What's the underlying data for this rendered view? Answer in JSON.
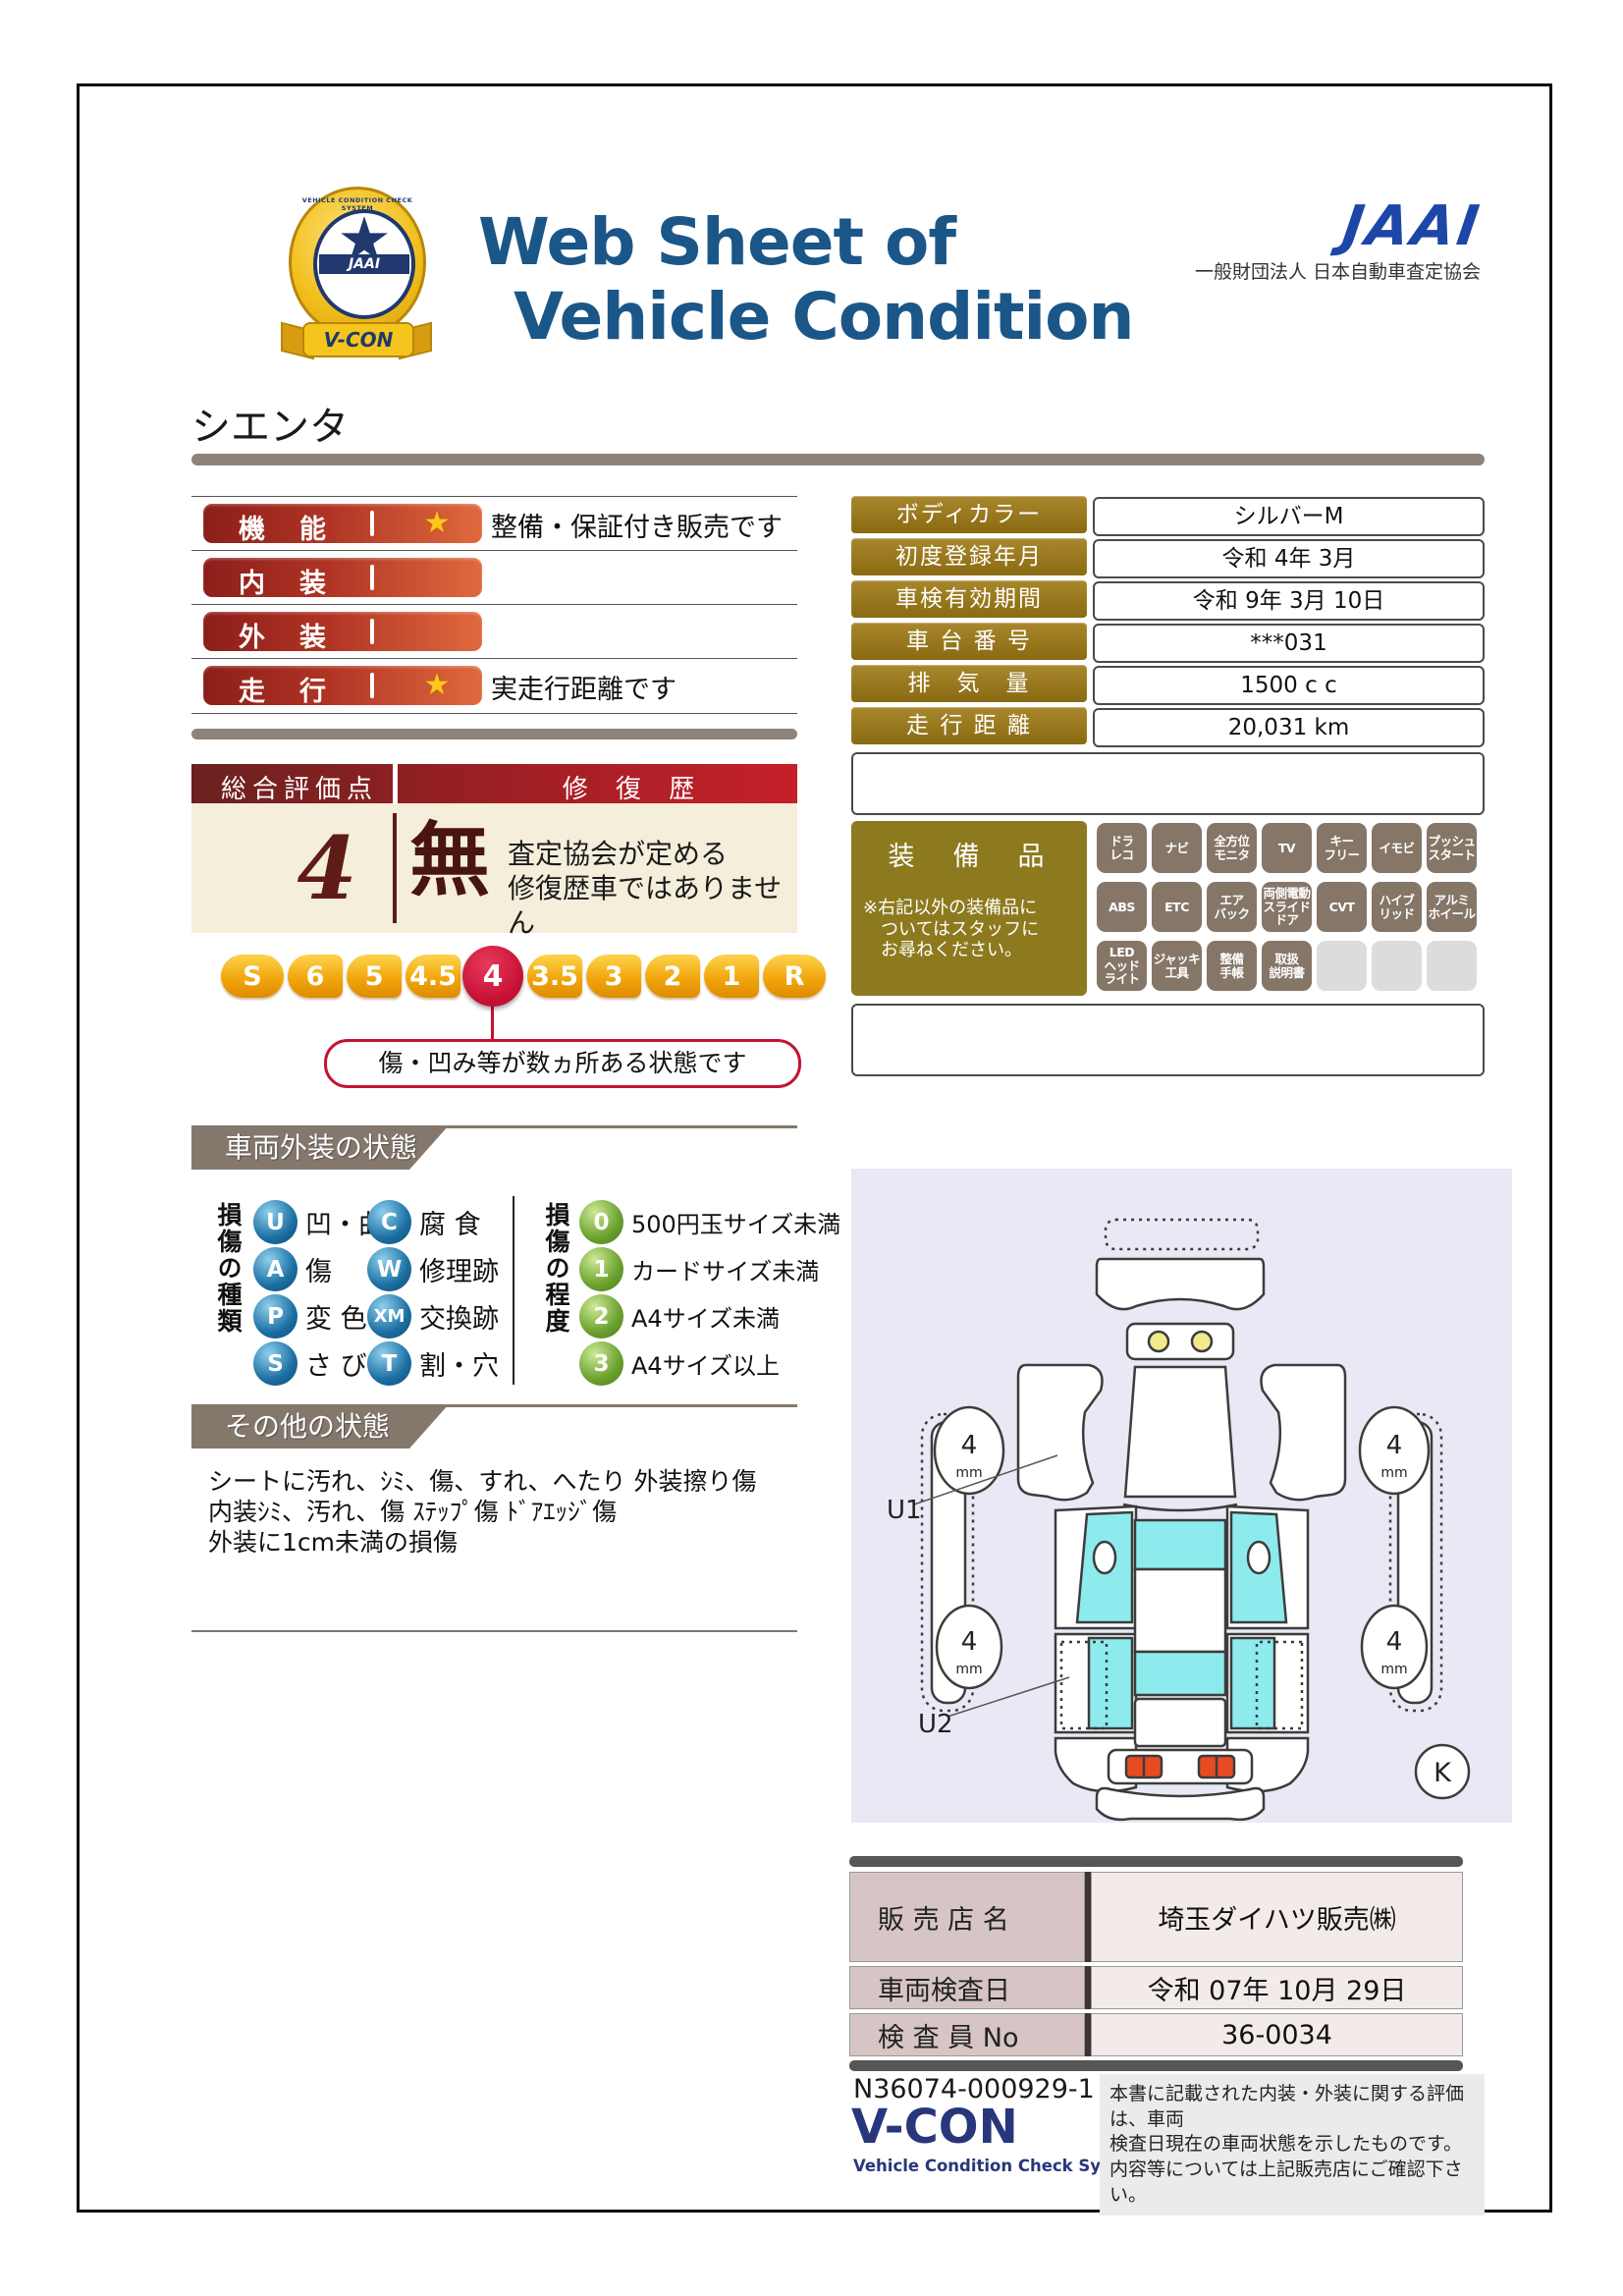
{
  "header": {
    "title_line1": "Web Sheet of",
    "title_line2": "Vehicle Condition",
    "emblem": {
      "name": "V-CON",
      "jaai": "JAAI",
      "ring_text": "VEHICLE CONDITION CHECK SYSTEM",
      "star_icon": "★"
    },
    "jaai": {
      "logo": "JAAI",
      "org": "一般財団法人 日本自動車査定協会"
    }
  },
  "vehicle_name": "シエンタ",
  "ratings": [
    {
      "label": "機　能",
      "star": "★",
      "note": "整備・保証付き販売です"
    },
    {
      "label": "内　装",
      "star": "",
      "note": ""
    },
    {
      "label": "外　装",
      "star": "",
      "note": ""
    },
    {
      "label": "走　行",
      "star": "★",
      "note": "実走行距離です"
    }
  ],
  "overall": {
    "header_left": "総合評価点",
    "header_right": "修 復 歴",
    "score": "4",
    "repair_mark": "無",
    "repair_note": "査定協会が定める\n修復歴車ではありません",
    "scale": [
      "S",
      "6",
      "5",
      "4.5",
      "4",
      "3.5",
      "3",
      "2",
      "1",
      "R"
    ],
    "selected_value": "4",
    "callout": "傷・凹み等が数ヵ所ある状態です"
  },
  "info_table": {
    "rows": [
      {
        "label": "ボディカラー",
        "value": "シルバーM"
      },
      {
        "label": "初度登録年月",
        "value": "令和 4年 3月"
      },
      {
        "label": "車検有効期間",
        "value": "令和 9年 3月 10日"
      },
      {
        "label": "車 台 番 号",
        "value": "***031"
      },
      {
        "label": "排　気　量",
        "value": "1500 c c"
      },
      {
        "label": "走 行 距 離",
        "value": "20,031 km"
      }
    ]
  },
  "equipment": {
    "title": "装　備　品",
    "note": "※右記以外の装備品に\n　ついてはスタッフに\n　お尋ねください。",
    "badges": [
      "ドラ\nレコ",
      "ナビ",
      "全方位\nモニタ",
      "TV",
      "キー\nフリー",
      "イモビ",
      "プッシュ\nスタート",
      "ABS",
      "ETC",
      "エア\nバック",
      "両側電動\nスライド\nドア",
      "CVT",
      "ハイブ\nリッド",
      "アルミ\nホイール",
      "LED\nヘッド\nライト",
      "ジャッキ\n工具",
      "整備\n手帳",
      "取扱\n説明書",
      "",
      "",
      ""
    ]
  },
  "exterior": {
    "title": "車両外装の状態",
    "kind_header": "損傷の種類",
    "kinds": [
      {
        "code": "U",
        "label": "凹・曲"
      },
      {
        "code": "A",
        "label": "傷"
      },
      {
        "code": "P",
        "label": "変 色"
      },
      {
        "code": "S",
        "label": "さ び"
      },
      {
        "code": "C",
        "label": "腐 食"
      },
      {
        "code": "W",
        "label": "修理跡"
      },
      {
        "code": "XM",
        "label": "交換跡"
      },
      {
        "code": "T",
        "label": "割・穴"
      }
    ],
    "degree_header": "損傷の程度",
    "degrees": [
      {
        "code": "0",
        "label": "500円玉サイズ未満"
      },
      {
        "code": "1",
        "label": "カードサイズ未満"
      },
      {
        "code": "2",
        "label": "A4サイズ未満"
      },
      {
        "code": "3",
        "label": "A4サイズ以上"
      }
    ]
  },
  "other": {
    "title": "その他の状態",
    "lines": [
      "シートに汚れ、ｼﾐ、傷、すれ、へたり 外装擦り傷",
      "内装ｼﾐ、汚れ、傷 ｽﾃｯﾌﾟ傷 ﾄﾞｱｴｯｼﾞ傷",
      "外装に1cm未満の損傷"
    ]
  },
  "diagram": {
    "tread_front_left": "4",
    "tread_front_right": "4",
    "tread_rear_left": "4",
    "tread_rear_right": "4",
    "tread_unit": "mm",
    "marker_u1": "U1",
    "marker_u2": "U2",
    "corner_mark": "K"
  },
  "dealer": {
    "rows": [
      {
        "label": "販 売 店 名",
        "value": "埼玉ダイハツ販売㈱"
      },
      {
        "label": "車両検査日",
        "value": "令和 07年 10月 29日"
      },
      {
        "label": "検 査 員 No",
        "value": "36-0034"
      }
    ]
  },
  "footer": {
    "serial": "N36074-000929-1",
    "vcon_logo": "V-CON",
    "vcon_tagline": "Vehicle Condition Check System",
    "disclaimer": "本書に記載された内装・外装に関する評価は、車両\n検査日現在の車両状態を示したものです。\n内容等については上記販売店にご確認下さい。"
  },
  "colors": {
    "title_navy": "#1b5688",
    "jaai_blue": "#1c46a8",
    "rating_red": "#8c1e1a",
    "gold_label": "#9c7d22",
    "score_maroon": "#5f1b16",
    "scale_gold": "#f2a60d",
    "selected_crimson": "#c40e33",
    "section_taupe": "#84786d",
    "badge_taupe": "#857668",
    "sphere_blue": "#1c6fa3",
    "sphere_green": "#6ba02e",
    "diagram_bg": "#e9e9f5",
    "glass_cyan": "#8debee",
    "dealer_label_pink": "#d7c5c5"
  }
}
